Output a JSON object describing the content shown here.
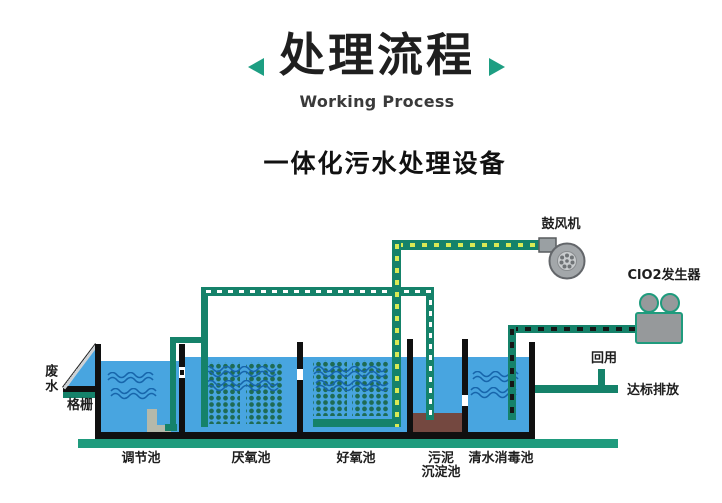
{
  "header": {
    "title": "处理流程",
    "subtitle_en": "Working Process",
    "device_heading": "一体化污水处理设备"
  },
  "diagram": {
    "inflow_label": "废水",
    "screen_label": "格栅",
    "tanks": {
      "regulation": "调节池",
      "anaerobic": "厌氧池",
      "aerobic": "好氧池",
      "sludge_line1": "污泥",
      "sludge_line2": "沉淀池",
      "disinfection": "清水消毒池"
    },
    "equipment": {
      "blower": "鼓风机",
      "clo2_generator": "ClO2发生器"
    },
    "outputs": {
      "reuse": "回用",
      "discharge": "达标排放"
    },
    "icons": {
      "title_left_arrow": "left-triangle-icon",
      "title_right_arrow": "right-triangle-icon",
      "blower": "centrifugal-blower-icon",
      "clo2_generator": "dosing-machine-icon",
      "pump": "submersible-pump-icon",
      "bar_screen": "inclined-screen-icon"
    }
  },
  "colors": {
    "teal_pipe": "#15826a",
    "teal_base": "#1f9b7d",
    "arrow_teal": "#1d9e82",
    "water_blue": "#48a5e0",
    "wave_blue": "#1765ab",
    "dot_green": "#1e6b54",
    "dash_yellow": "#d9ea55",
    "dash_white": "#ffffff",
    "dash_black": "#161616",
    "sludge_brown": "#744840",
    "machine_gray": "#96999b",
    "wall_black": "#101010"
  }
}
